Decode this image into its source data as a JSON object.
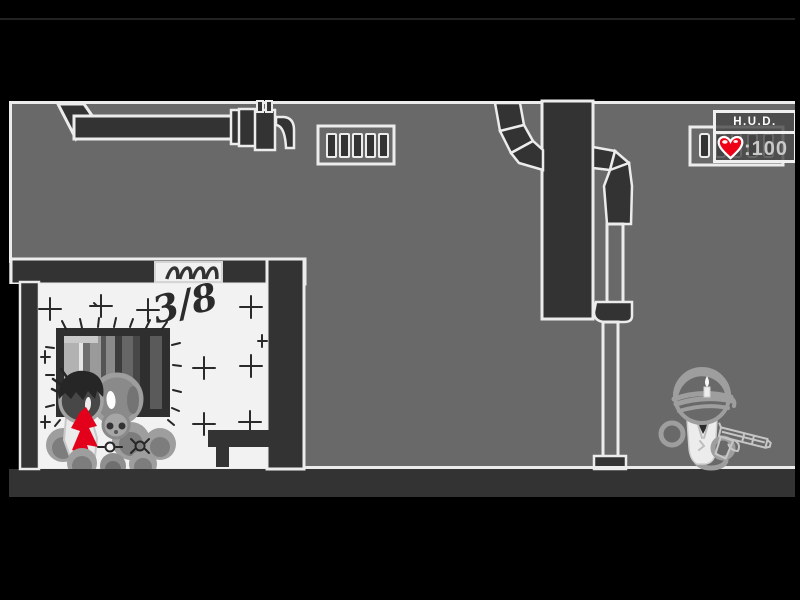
{
  "hud": {
    "title": "H.U.D.",
    "health_value": ":100",
    "heart_icon": "heart-icon",
    "colors": {
      "heart": "#ee0016",
      "panel_border": "#f0f0f0",
      "title_text": "#ffffff",
      "health_text": "#c9c9c9"
    }
  },
  "room": {
    "graffiti": "3/8",
    "plaque_icon": "arch-tally-icon",
    "window_icon": "barred-window-icon",
    "bench_icon": "bench-icon"
  },
  "scene": {
    "vent_icons": [
      "wall-vent-top-icon",
      "wall-vent-right-icon"
    ],
    "duct_icons": [
      "ceiling-duct-left-icon",
      "column-duct-icon",
      "drain-pipe-icon"
    ],
    "figures": {
      "body_pile": "body-pile",
      "blood": "blood-splatter",
      "gunman": "gunman-with-pistol"
    },
    "colors": {
      "background": "#000000",
      "wall": "#696969",
      "dark_structure": "#333333",
      "outline": "#ececec",
      "room_interior": "#f2f2f2",
      "blood": "#e3001b",
      "figure_gray": "#9e9e9e"
    }
  }
}
